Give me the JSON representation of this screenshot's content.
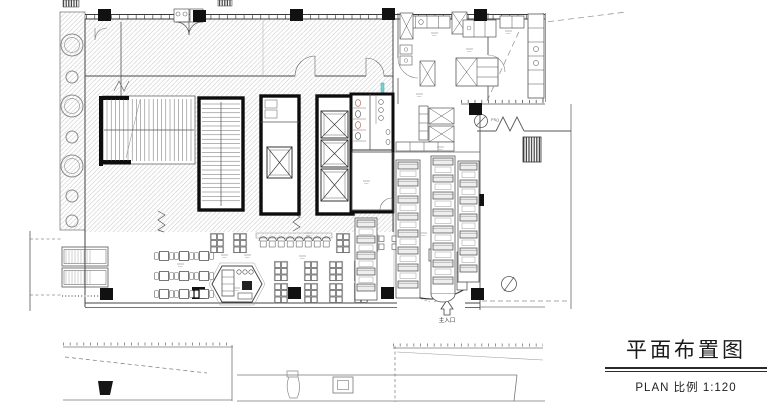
{
  "title_block": {
    "title": "平面布置图",
    "subtitle": "PLAN 比例 1:120"
  },
  "plan": {
    "labels": {
      "main_entrance": "主入口",
      "riser": "PS()"
    },
    "columns": [
      [
        98,
        9
      ],
      [
        193,
        10
      ],
      [
        290,
        9
      ],
      [
        382,
        8
      ],
      [
        474,
        9
      ],
      [
        469,
        103
      ],
      [
        471,
        194
      ],
      [
        192,
        287
      ],
      [
        288,
        287
      ],
      [
        381,
        287
      ],
      [
        471,
        288
      ],
      [
        100,
        288
      ]
    ],
    "trees": [
      [
        72,
        45,
        11
      ],
      [
        72,
        77,
        6
      ],
      [
        72,
        106,
        11
      ],
      [
        72,
        137,
        6
      ],
      [
        72,
        166,
        11
      ],
      [
        72,
        196,
        6
      ],
      [
        72,
        221,
        6
      ]
    ],
    "tables4": [
      [
        164,
        256
      ],
      [
        184,
        256
      ],
      [
        204,
        256
      ],
      [
        164,
        276
      ],
      [
        184,
        276
      ],
      [
        204,
        276
      ],
      [
        164,
        294
      ],
      [
        184,
        294
      ],
      [
        204,
        294
      ]
    ],
    "clusters6": [
      [
        217,
        243
      ],
      [
        240,
        243
      ],
      [
        343,
        243
      ],
      [
        281,
        271
      ],
      [
        311,
        271
      ],
      [
        336,
        271
      ],
      [
        361,
        271
      ],
      [
        281,
        293
      ],
      [
        311,
        293
      ],
      [
        336,
        293
      ],
      [
        361,
        293
      ]
    ],
    "clusters4": [
      [
        375,
        243
      ],
      [
        401,
        243
      ]
    ],
    "stool_row": {
      "x": 259,
      "y": 241,
      "count": 8,
      "step": 9
    },
    "booths": [
      {
        "x": 397,
        "y": 162,
        "w": 22,
        "count": 8,
        "step": 17
      },
      {
        "x": 432,
        "y": 158,
        "w": 22,
        "count": 8,
        "step": 17,
        "round_end": true
      },
      {
        "x": 459,
        "y": 163,
        "w": 19,
        "count": 7,
        "step": 17
      },
      {
        "x": 356,
        "y": 220,
        "w": 20,
        "count": 5,
        "step": 16
      }
    ],
    "elevators": [
      [
        267,
        147,
        25,
        31
      ],
      [
        321,
        111,
        27,
        27
      ],
      [
        321,
        140,
        27,
        27
      ],
      [
        321,
        169,
        27,
        32
      ]
    ]
  },
  "colors": {
    "wall": "#111111",
    "line": "#4a4a4a",
    "hatch": "#c3c3c3",
    "accent_teal": "#7ccfcf",
    "accent_red": "#b06a6a"
  }
}
